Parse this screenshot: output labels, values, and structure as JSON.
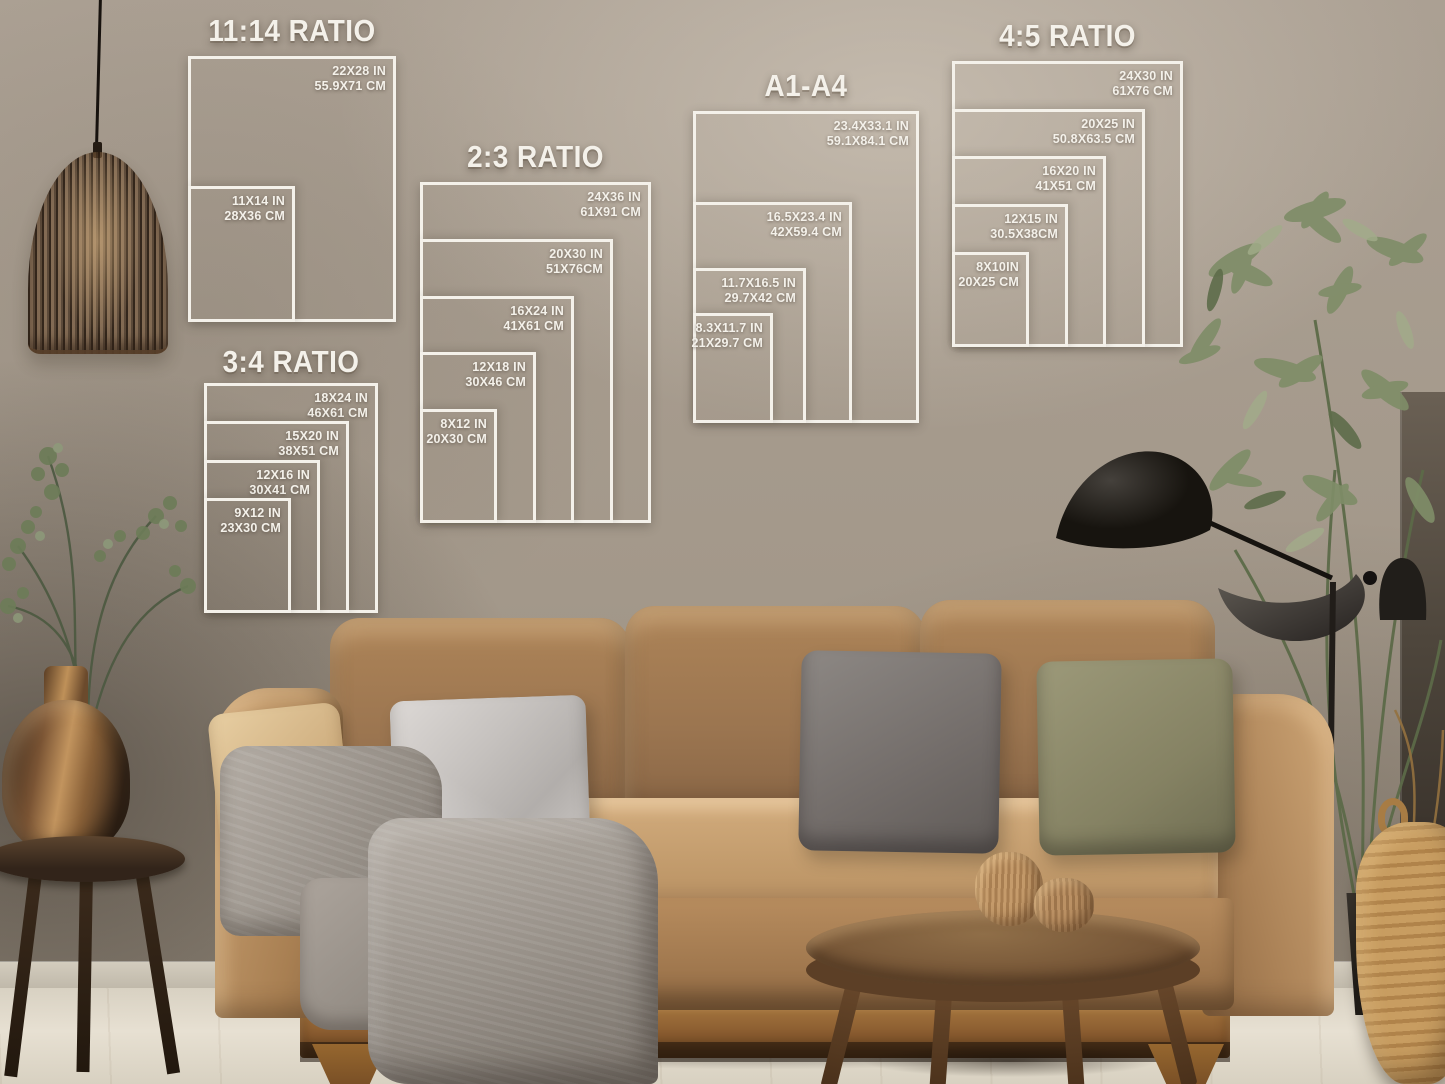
{
  "colors": {
    "line": "#f4f1ea",
    "wall": "#a79c8f",
    "wall_light": "#c9bfb1",
    "wall_dark": "#6b6257",
    "floor": "#ded7c9",
    "sofa": "#b98f60",
    "wood": "#8a5f36",
    "blanket": "#9d968e",
    "pillow_silver": "#c8c4c1",
    "pillow_gray": "#7b7572",
    "pillow_olive": "#8d8a6b",
    "pillow_beige": "#d9bc8f",
    "lamp_black": "#23201d",
    "plant_green": "#7c8a66",
    "bronze": "#8a6444",
    "basket": "#c0955c"
  },
  "size_charts": [
    {
      "title": "11:14 RATIO",
      "sizes": [
        {
          "in": "22X28 IN",
          "cm": "55.9X71 CM"
        },
        {
          "in": "11X14 IN",
          "cm": "28X36 CM"
        }
      ]
    },
    {
      "title": "2:3 RATIO",
      "sizes": [
        {
          "in": "24X36 IN",
          "cm": "61X91 CM"
        },
        {
          "in": "20X30 IN",
          "cm": "51X76CM"
        },
        {
          "in": "16X24 IN",
          "cm": "41X61 CM"
        },
        {
          "in": "12X18 IN",
          "cm": "30X46 CM"
        },
        {
          "in": "8X12 IN",
          "cm": "20X30 CM"
        }
      ]
    },
    {
      "title": "3:4 RATIO",
      "sizes": [
        {
          "in": "18X24 IN",
          "cm": "46X61 CM"
        },
        {
          "in": "15X20 IN",
          "cm": "38X51 CM"
        },
        {
          "in": "12X16 IN",
          "cm": "30X41 CM"
        },
        {
          "in": "9X12 IN",
          "cm": "23X30 CM"
        }
      ]
    },
    {
      "title": "A1-A4",
      "sizes": [
        {
          "in": "23.4X33.1 IN",
          "cm": "59.1X84.1 CM"
        },
        {
          "in": "16.5X23.4 IN",
          "cm": "42X59.4 CM"
        },
        {
          "in": "11.7X16.5 IN",
          "cm": "29.7X42 CM"
        },
        {
          "in": "8.3X11.7 IN",
          "cm": "21X29.7 CM"
        }
      ]
    },
    {
      "title": "4:5 RATIO",
      "sizes": [
        {
          "in": "24X30 IN",
          "cm": "61X76 CM"
        },
        {
          "in": "20X25 IN",
          "cm": "50.8X63.5 CM"
        },
        {
          "in": "16X20 IN",
          "cm": "41X51 CM"
        },
        {
          "in": "12X15 IN",
          "cm": "30.5X38CM"
        },
        {
          "in": "8X10IN",
          "cm": "20X25 CM"
        }
      ]
    }
  ]
}
